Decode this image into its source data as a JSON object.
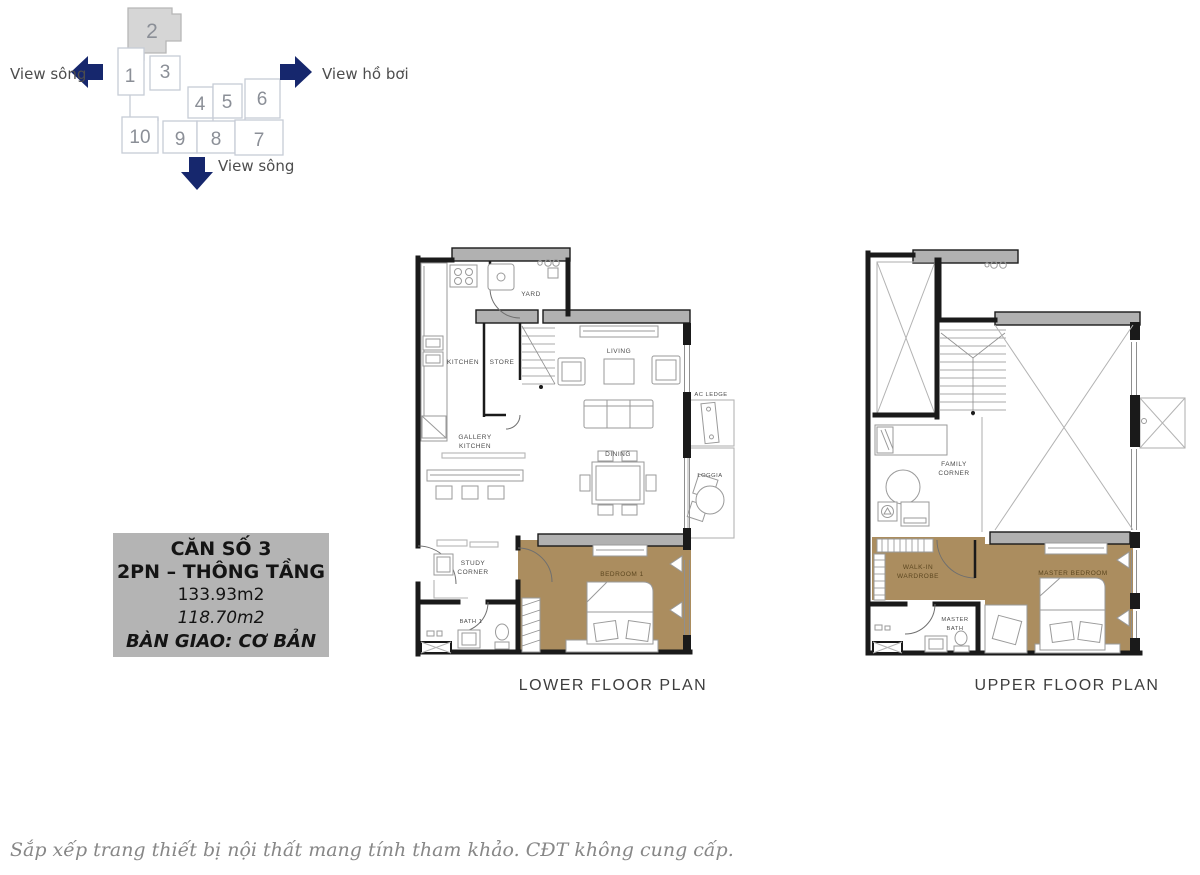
{
  "colors": {
    "arrow_navy": "#16276d",
    "highlighted_unit_gray": "#d6d6d6",
    "wall_gray": "#b1b1b1",
    "bedroom_tan": "#ab8d5f",
    "info_box_gray": "#b4b4b4"
  },
  "locator": {
    "units": [
      "1",
      "2",
      "3",
      "4",
      "5",
      "6",
      "7",
      "8",
      "9",
      "10"
    ],
    "highlighted_unit": "2",
    "view_left": "View sông",
    "view_right": "View hồ bơi",
    "view_bottom": "View sông"
  },
  "info_box": {
    "line1": "CĂN SỐ 3",
    "line2": "2PN – THÔNG TẦNG",
    "line3": "133.93m2",
    "line4": "118.70m2",
    "line5": "BÀN GIAO: CƠ BẢN"
  },
  "lower_plan": {
    "caption": "LOWER FLOOR PLAN",
    "rooms": {
      "kitchen": "KITCHEN",
      "store": "STORE",
      "yard": "YARD",
      "living": "LIVING",
      "ac_ledge": "AC LEDGE",
      "gallery_1": "GALLERY",
      "gallery_2": "KITCHEN",
      "dining": "DINING",
      "loggia": "LOGGIA",
      "study_1": "STUDY",
      "study_2": "CORNER",
      "bath1": "BATH 1",
      "bedroom1": "BEDROOM 1"
    }
  },
  "upper_plan": {
    "caption": "UPPER FLOOR PLAN",
    "rooms": {
      "family_1": "FAMILY",
      "family_2": "CORNER",
      "walkin_1": "WALK-IN",
      "walkin_2": "WARDROBE",
      "master_bath_1": "MASTER",
      "master_bath_2": "BATH",
      "master_bedroom": "MASTER BEDROOM"
    }
  },
  "footnote": "Sắp xếp trang thiết bị nội thất mang tính tham khảo. CĐT không cung cấp."
}
